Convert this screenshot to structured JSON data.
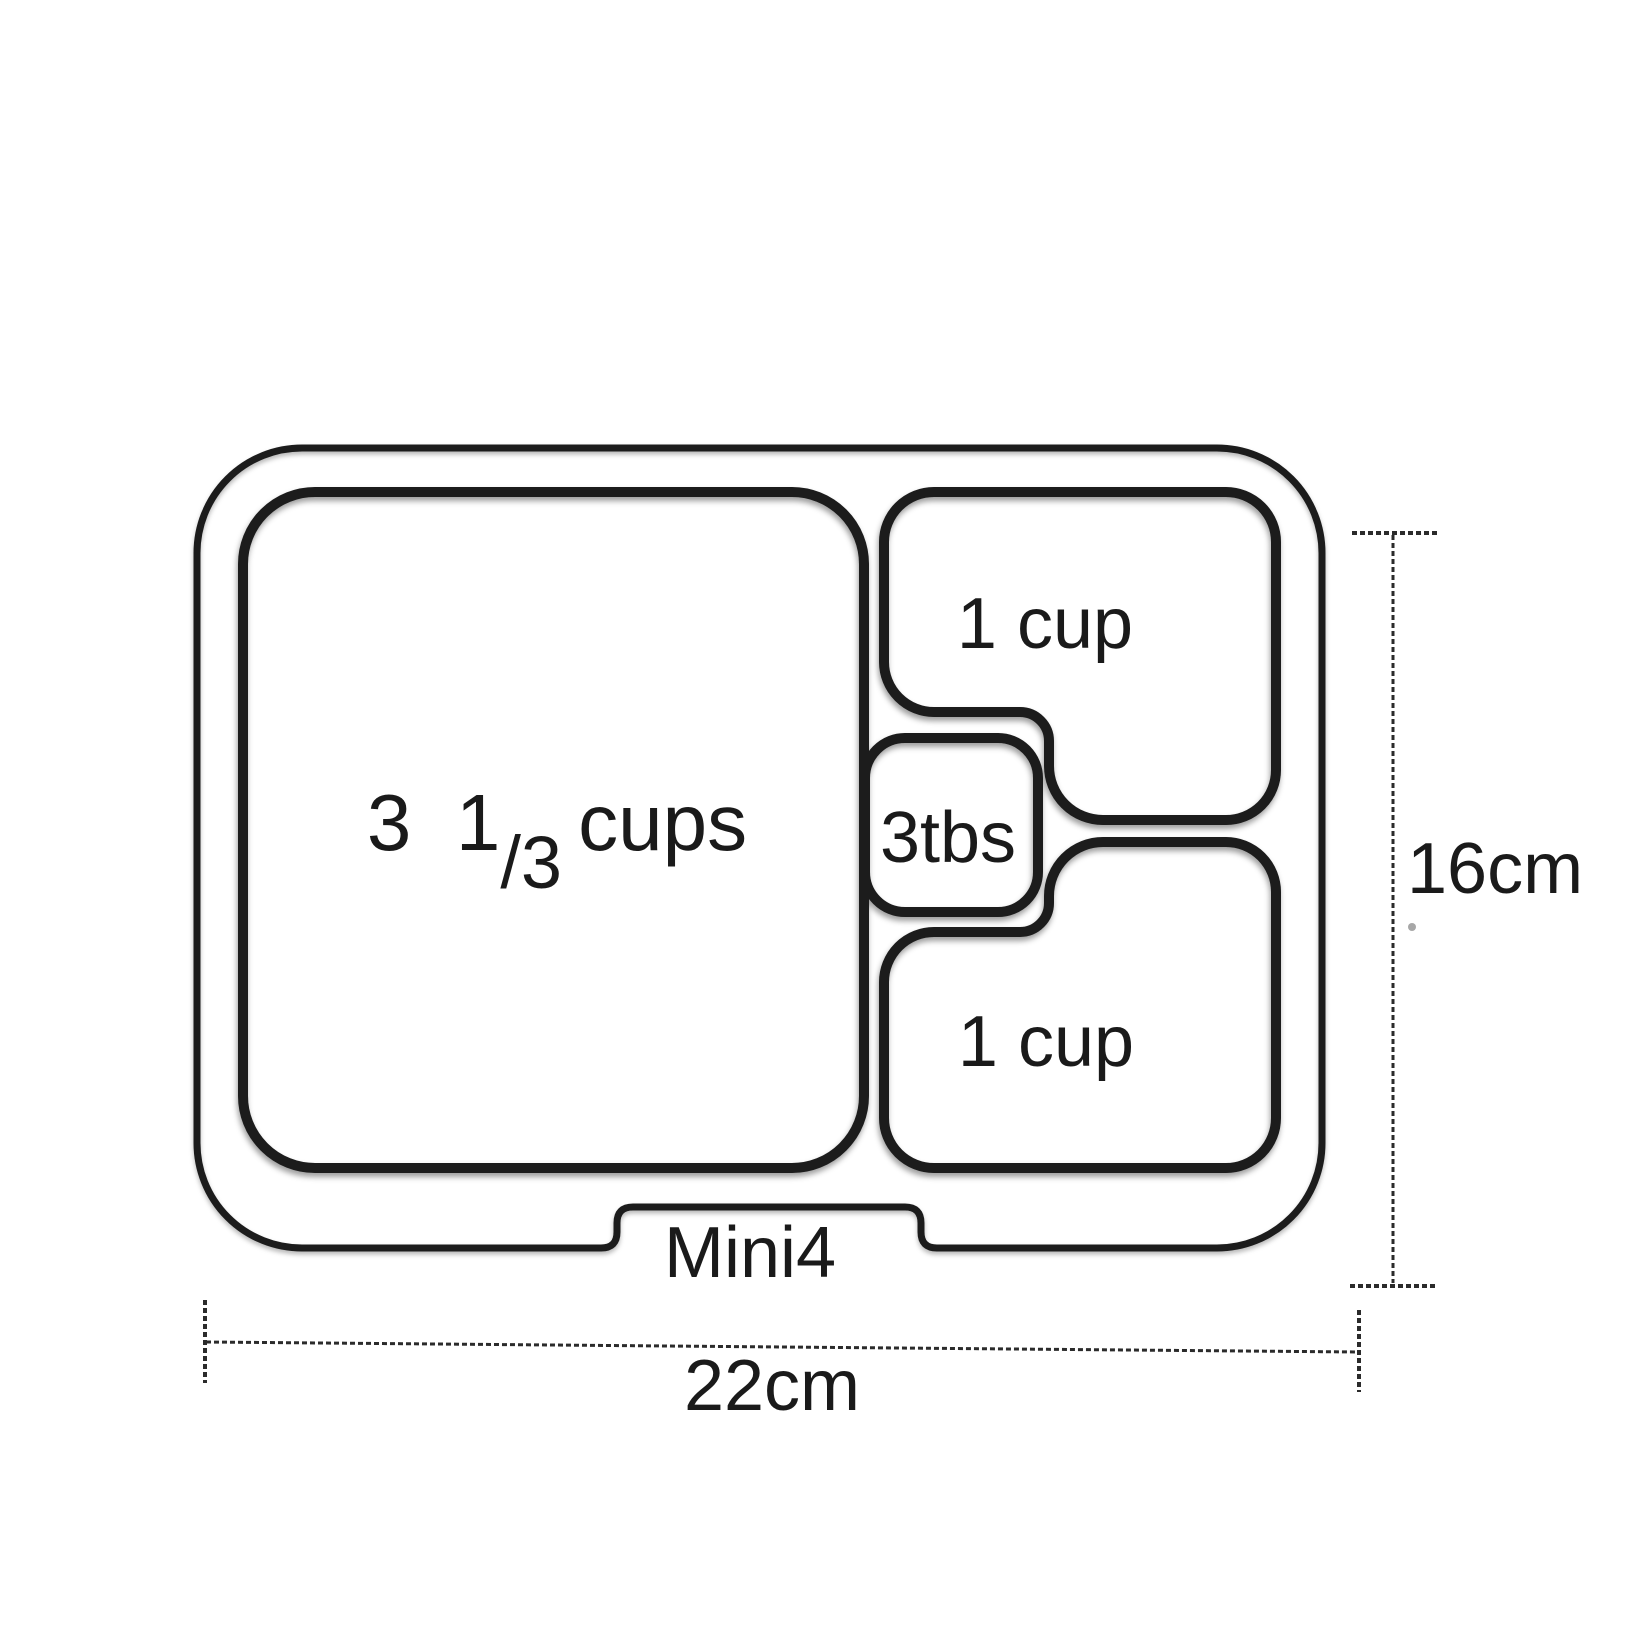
{
  "diagram": {
    "product_label": "Mini4",
    "compartments": {
      "main": {
        "label": "3 1/3 cups",
        "whole_part": "3  1",
        "fraction_part": "/3",
        "unit_part": "cups"
      },
      "top_right": {
        "label": "1 cup"
      },
      "center_small": {
        "label": "3tbs"
      },
      "bottom_right": {
        "label": "1 cup"
      }
    },
    "dimensions": {
      "width": "22cm",
      "height": "16cm"
    },
    "colors": {
      "line": "#1b1b1b",
      "text": "#1a1a1a",
      "dimension_line": "#2b2b2b",
      "background": "#ffffff"
    }
  }
}
